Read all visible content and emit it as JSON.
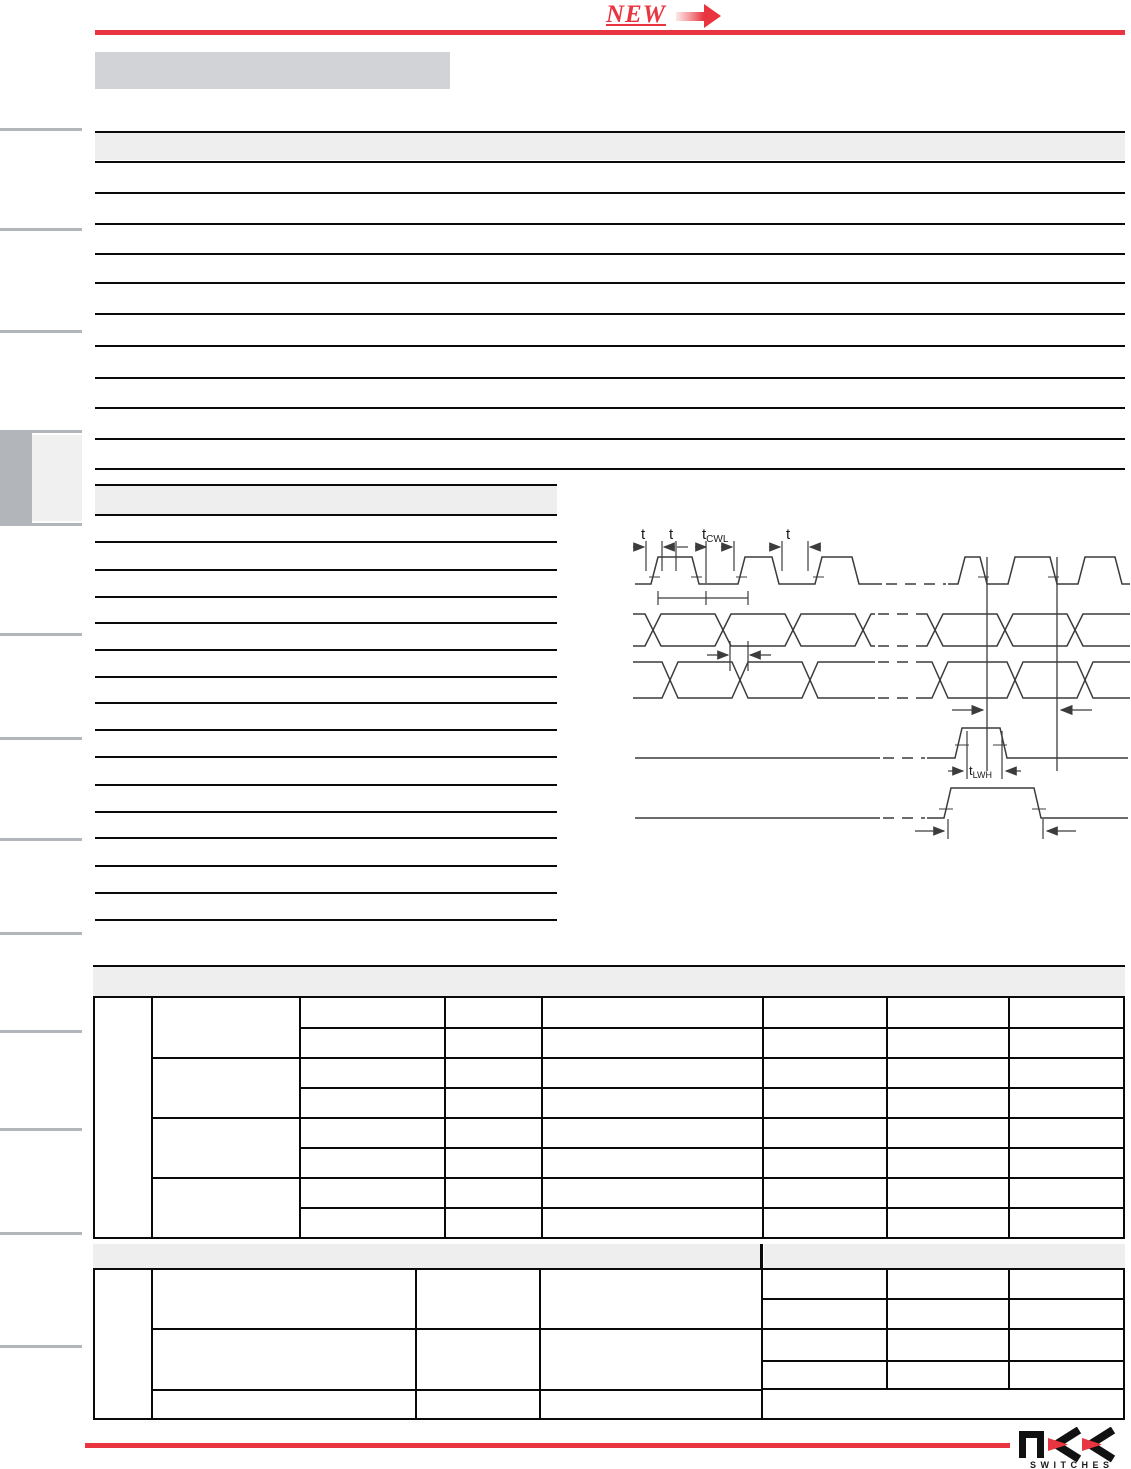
{
  "badge": {
    "label": "NEW"
  },
  "brand": {
    "word": "NKK",
    "tagline": "SWITCHES"
  },
  "timing_diagram": {
    "labels": {
      "t1": "t",
      "t2": "t",
      "t_cwl_base": "t",
      "t_cwl_sub": "CWL",
      "t4": "t",
      "t_lwh_base": "t",
      "t_lwh_sub": "LWH"
    }
  },
  "colors": {
    "accent_red": "#e8353f",
    "title_band_gray": "#d2d3d6",
    "section_band_gray": "#eeeeef",
    "tab_gray": "#b2b5b9",
    "tab_highlight": "#f0f0f0",
    "table_line_black": "#0a0a0a",
    "diagram_stroke": "#3c3c3c"
  }
}
